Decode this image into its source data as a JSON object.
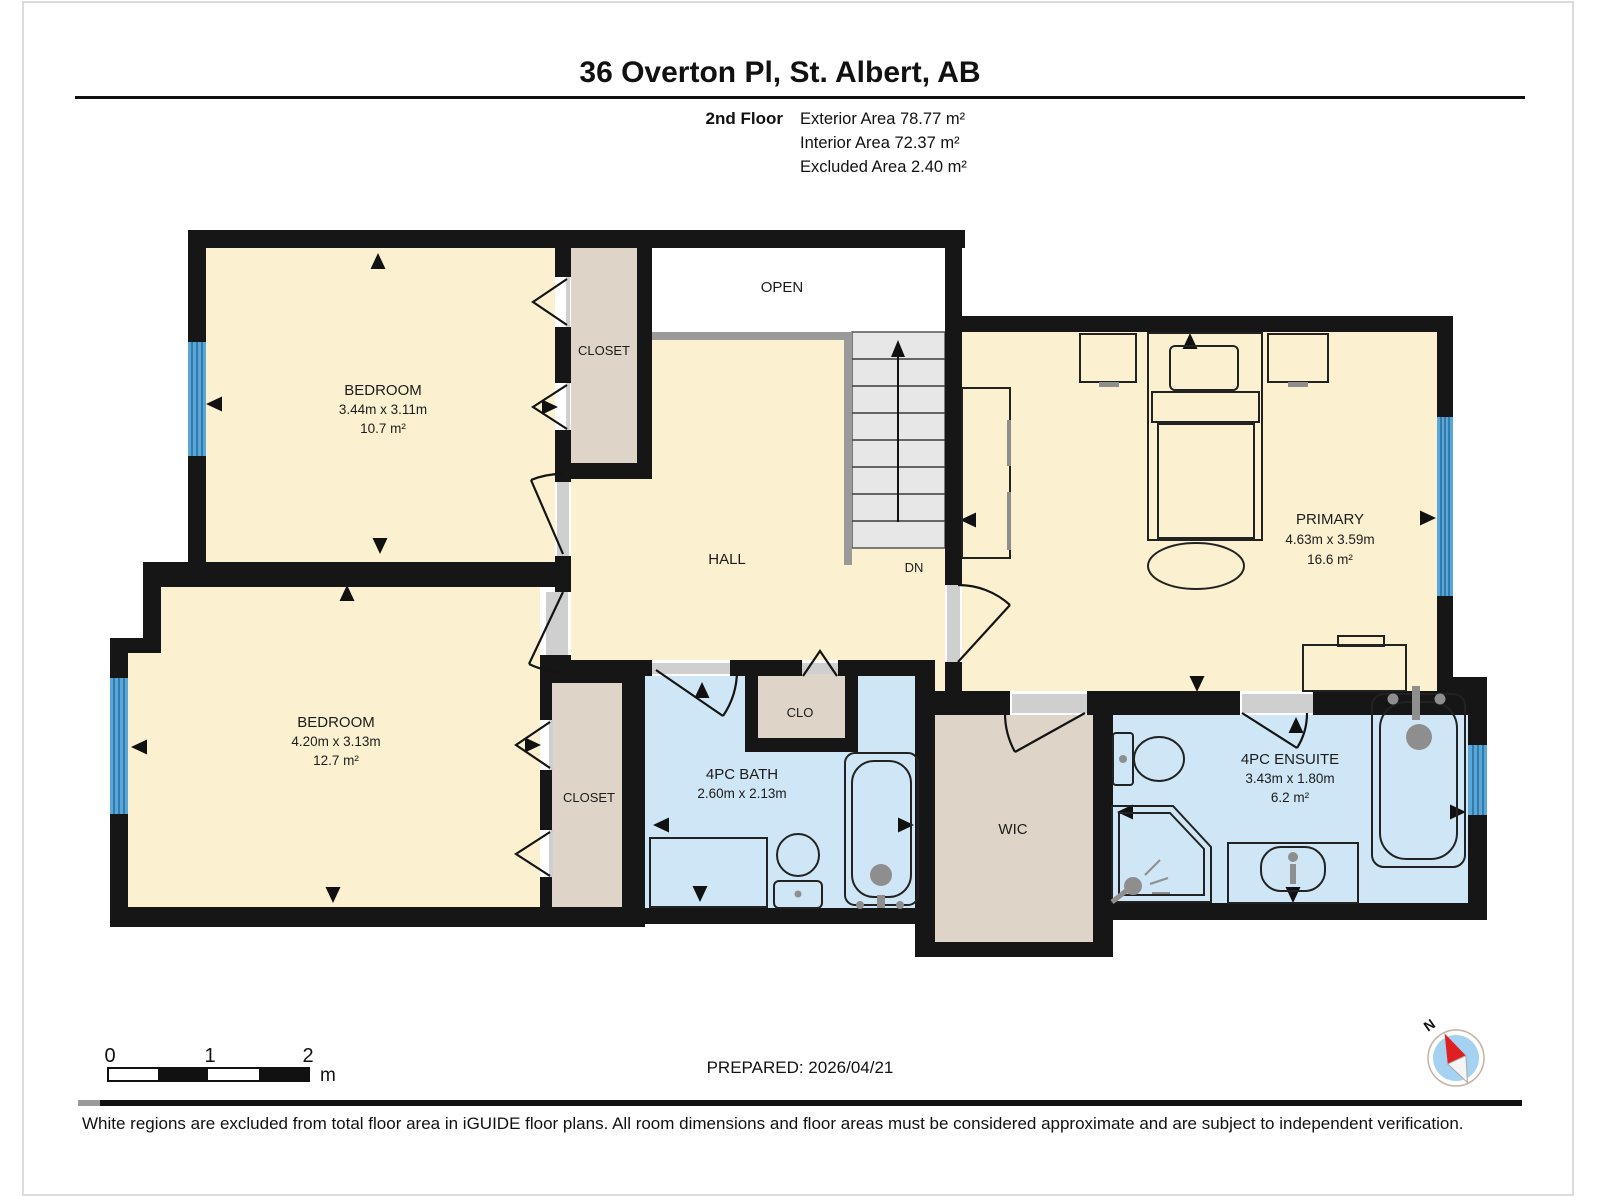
{
  "header": {
    "title": "36 Overton Pl, St. Albert, AB",
    "floor_label": "2nd Floor",
    "stats": {
      "exterior": "Exterior Area 78.77 m²",
      "interior": "Interior Area 72.37 m²",
      "excluded": "Excluded Area 2.40 m²"
    }
  },
  "rooms": {
    "bedroom_top": {
      "name": "BEDROOM",
      "dims": "3.44m x 3.11m",
      "area": "10.7 m²"
    },
    "bedroom_bottom": {
      "name": "BEDROOM",
      "dims": "4.20m x 3.13m",
      "area": "12.7 m²"
    },
    "primary": {
      "name": "PRIMARY",
      "dims": "4.63m x 3.59m",
      "area": "16.6 m²"
    },
    "bath": {
      "name": "4PC BATH",
      "dims": "2.60m x 2.13m"
    },
    "ensuite": {
      "name": "4PC ENSUITE",
      "dims": "3.43m x 1.80m",
      "area": "6.2 m²"
    },
    "closet_top": {
      "name": "CLOSET"
    },
    "closet_bottom": {
      "name": "CLOSET"
    },
    "clo": {
      "name": "CLO"
    },
    "wic": {
      "name": "WIC"
    },
    "hall": {
      "name": "HALL"
    },
    "open": {
      "name": "OPEN"
    },
    "stairs": {
      "name": "DN"
    }
  },
  "scale_bar": {
    "labels": [
      "0",
      "1",
      "2"
    ],
    "unit": "m"
  },
  "compass": {
    "north": "N"
  },
  "footer": {
    "prepared": "PREPARED: 2026/04/21",
    "disclaimer": "White regions are excluded from total floor area in iGUIDE floor plans. All room dimensions and floor areas must be considered approximate and are subject to independent verification."
  },
  "colors": {
    "wall": "#161616",
    "floor": "#fbf1d1",
    "closet": "#ded5c8",
    "bath": "#cfe6f6",
    "window": "#58a7d8",
    "stairs": "#e7e7e7",
    "railing": "#9a9a9a",
    "open_area": "#ffffff",
    "jamb": "#cfcfcf",
    "compass_disc": "#a5d2f0",
    "compass_needle": "#e02020"
  }
}
